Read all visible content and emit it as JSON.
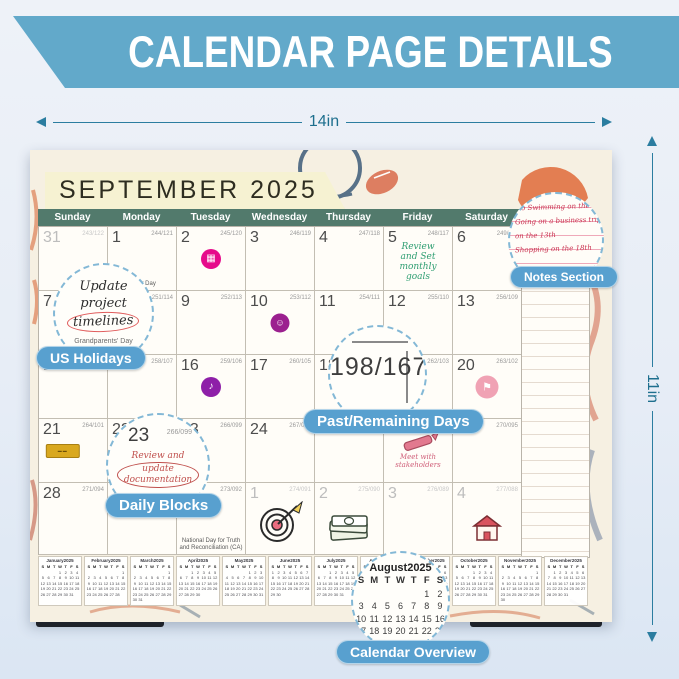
{
  "banner": {
    "title": "CALENDAR PAGE DETAILS"
  },
  "dimensions": {
    "width_label": "14in",
    "height_label": "11in"
  },
  "calendar": {
    "title": "SEPTEMBER 2025",
    "day_headers": [
      "Sunday",
      "Monday",
      "Tuesday",
      "Wednesday",
      "Thursday",
      "Friday",
      "Saturday"
    ],
    "notes_header": "Notes",
    "weekday_letters": [
      "S",
      "M",
      "T",
      "W",
      "T",
      "F",
      "S"
    ],
    "notes_lines": [
      "No Swimming on the 3rd",
      "Going on a business trip",
      "on the 13th",
      "Shopping on the 18th"
    ],
    "cells": [
      {
        "day": "31",
        "counter": "243/122",
        "muted": true
      },
      {
        "day": "1",
        "counter": "244/121",
        "holiday": "Labor Day"
      },
      {
        "day": "2",
        "counter": "245/120",
        "sticker": "pink"
      },
      {
        "day": "3",
        "counter": "246/119"
      },
      {
        "day": "4",
        "counter": "247/118"
      },
      {
        "day": "5",
        "counter": "248/117",
        "note": {
          "color": "green",
          "lines": [
            "Review",
            "and Set",
            "monthly",
            "goals"
          ]
        }
      },
      {
        "day": "6",
        "counter": "249/116"
      },
      {
        "day": "7",
        "counter": "250/115"
      },
      {
        "day": "8",
        "counter": "251/114"
      },
      {
        "day": "9",
        "counter": "252/113"
      },
      {
        "day": "10",
        "counter": "253/112",
        "sticker": "purple"
      },
      {
        "day": "11",
        "counter": "254/111"
      },
      {
        "day": "12",
        "counter": "255/110"
      },
      {
        "day": "13",
        "counter": "256/109"
      },
      {
        "day": "14",
        "counter": "257/108"
      },
      {
        "day": "15",
        "counter": "258/107"
      },
      {
        "day": "16",
        "counter": "259/106",
        "sticker": "violet"
      },
      {
        "day": "17",
        "counter": "260/105"
      },
      {
        "day": "18",
        "counter": "261/104"
      },
      {
        "day": "19",
        "counter": "262/103"
      },
      {
        "day": "20",
        "counter": "263/102",
        "sticker": "rose"
      },
      {
        "day": "21",
        "counter": "264/101",
        "sticker": "tag"
      },
      {
        "day": "22",
        "counter": "265/100"
      },
      {
        "day": "23",
        "counter": "266/099"
      },
      {
        "day": "24",
        "counter": "267/098"
      },
      {
        "day": "25",
        "counter": "268/097"
      },
      {
        "day": "26",
        "counter": "269/096",
        "doodle": "crayon",
        "note": {
          "color": "red",
          "lines": [
            "Meet with",
            "stakeholders"
          ]
        }
      },
      {
        "day": "27",
        "counter": "270/095"
      },
      {
        "day": "28",
        "counter": "271/094"
      },
      {
        "day": "29",
        "counter": "272/093"
      },
      {
        "day": "30",
        "counter": "273/092",
        "holiday": "National Day for Truth and Reconciliation (CA)"
      },
      {
        "day": "1",
        "counter": "274/091",
        "muted": true,
        "doodle": "dartboard"
      },
      {
        "day": "2",
        "counter": "275/090",
        "muted": true,
        "doodle": "money"
      },
      {
        "day": "3",
        "counter": "276/089",
        "muted": true
      },
      {
        "day": "4",
        "counter": "277/088",
        "muted": true,
        "doodle": "house"
      }
    ]
  },
  "callouts": {
    "us_holidays": "US Holidays",
    "past_remaining": "Past/Remaining Days",
    "daily_blocks": "Daily Blocks",
    "notes_section": "Notes Section",
    "calendar_overview": "Calendar Overview"
  },
  "lenses": {
    "cell7": {
      "lines": [
        "Update",
        "project",
        "timelines"
      ],
      "sub": "Grandparents' Day"
    },
    "counter": "198/167",
    "cell23": {
      "day": "23",
      "counter": "266/099",
      "lines": [
        "Review and",
        "update",
        "documentation"
      ]
    }
  },
  "mini_months": [
    {
      "label": "January2025",
      "start": 3,
      "days": 31
    },
    {
      "label": "February2025",
      "start": 6,
      "days": 28
    },
    {
      "label": "March2025",
      "start": 6,
      "days": 31
    },
    {
      "label": "April2025",
      "start": 2,
      "days": 30
    },
    {
      "label": "May2025",
      "start": 4,
      "days": 31
    },
    {
      "label": "June2025",
      "start": 0,
      "days": 30
    },
    {
      "label": "July2025",
      "start": 2,
      "days": 31
    },
    {
      "label": "August2025",
      "start": 5,
      "days": 31
    },
    {
      "label": "September2025",
      "start": 1,
      "days": 30
    },
    {
      "label": "October2025",
      "start": 3,
      "days": 31
    },
    {
      "label": "November2025",
      "start": 6,
      "days": 30
    },
    {
      "label": "December2025",
      "start": 1,
      "days": 31
    }
  ],
  "august_lens": {
    "label": "August2025",
    "start": 5,
    "days": 31
  },
  "colors": {
    "banner": "#62a9ca",
    "pill": "#58a0cf",
    "header_bar": "#527a6c",
    "title_tag": "#f6f2d2",
    "dimension": "#2b7da0"
  }
}
